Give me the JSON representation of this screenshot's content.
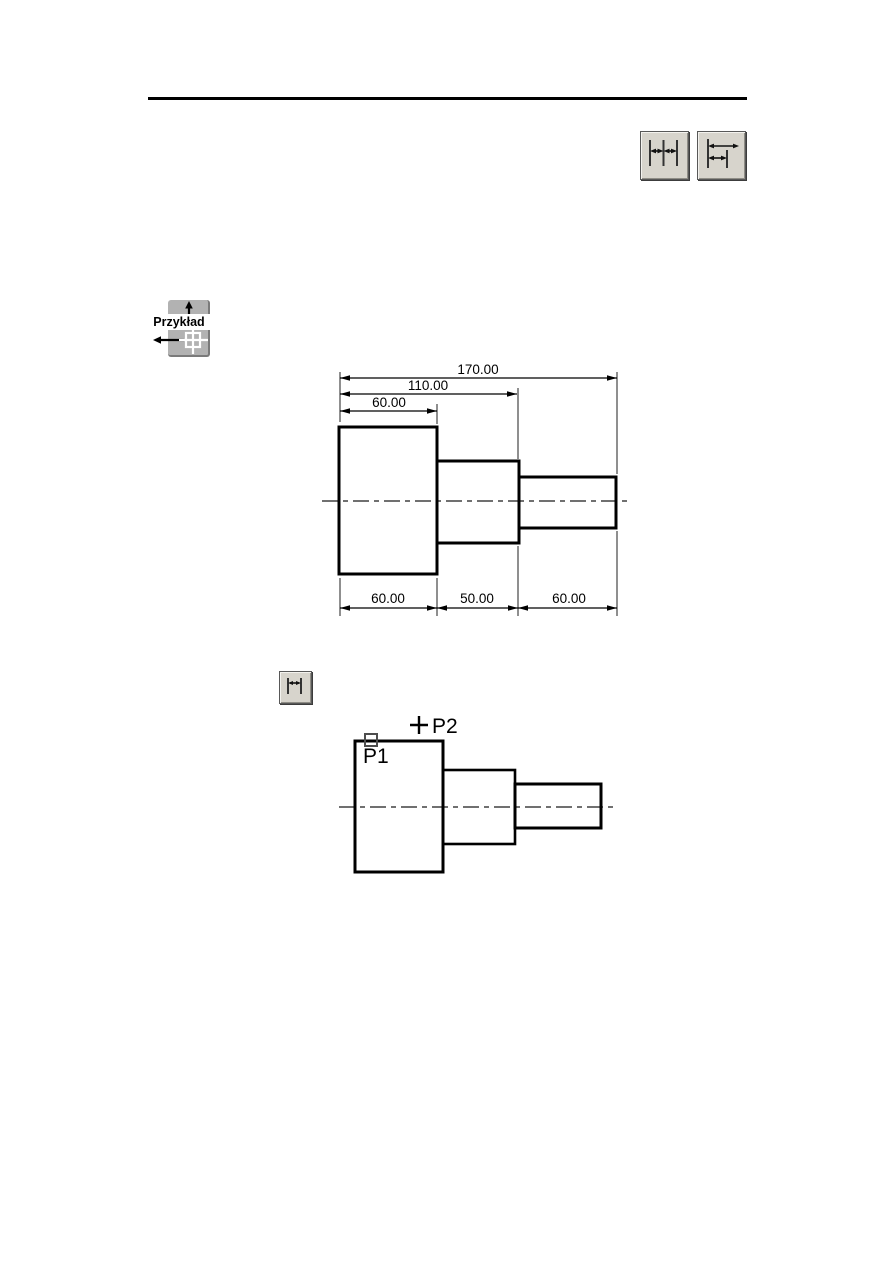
{
  "colors": {
    "line": "#000000",
    "button_face": "#d7d4cc",
    "icon_stroke": "#333333",
    "badge_gray": "#b2b2b2",
    "badge_shadow": "#7a7a7a"
  },
  "toolbar": {
    "continue_button": {
      "icon": "dimension-continue-icon"
    },
    "baseline_button": {
      "icon": "dimension-baseline-icon"
    }
  },
  "example_badge": {
    "label": "Przykład"
  },
  "linear_button": {
    "icon": "dimension-linear-icon"
  },
  "figure1": {
    "top_dims": {
      "total": "170.00",
      "mid": "110.00",
      "first": "60.00"
    },
    "bottom_dims": {
      "seg1": "60.00",
      "seg2": "50.00",
      "seg3": "60.00"
    }
  },
  "figure2": {
    "point1": "P1",
    "point2": "P2"
  }
}
